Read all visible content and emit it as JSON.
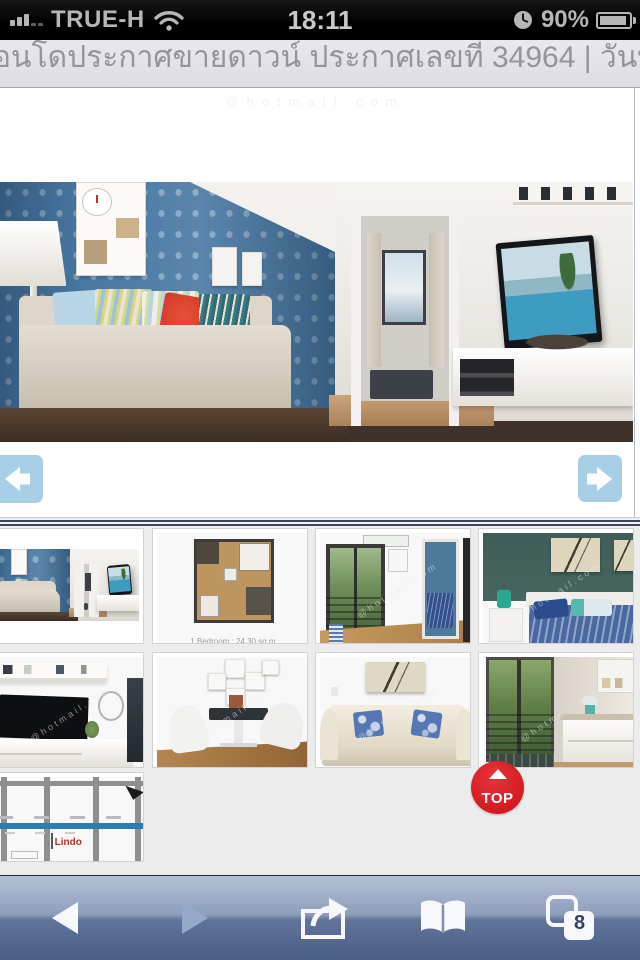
{
  "status_bar": {
    "carrier": "TRUE-H",
    "time": "18:11",
    "battery_percent": "90%"
  },
  "header": {
    "listing_info": "อนโดประกาศขายดาวน์ ประกาศเลขที่ 34964 | วันที่ประกาศ วันจันทร์ 10 กันย"
  },
  "gallery": {
    "watermark": "@hotmail.com",
    "floorplan_caption": "1 Bedroom : 24.30 sq.m.",
    "map_label": "Lindo",
    "thumbnails": [
      {
        "name": "living-room"
      },
      {
        "name": "floor-plan"
      },
      {
        "name": "hallway-balcony"
      },
      {
        "name": "bedroom"
      },
      {
        "name": "tv-cabinet"
      },
      {
        "name": "dining-area"
      },
      {
        "name": "sofa"
      },
      {
        "name": "kitchen-balcony"
      },
      {
        "name": "location-map"
      }
    ]
  },
  "top_button": {
    "label": "TOP"
  },
  "toolbar": {
    "pages_count": "8"
  },
  "colors": {
    "nav_arrow_blue": "#a9cfe7",
    "separator_navy": "#3c4656",
    "top_button_red": "#d8151c",
    "toolbar_top": "#b3c0d5",
    "toolbar_bottom": "#4a5d85",
    "status_text_gray": "#b6b6b6"
  }
}
